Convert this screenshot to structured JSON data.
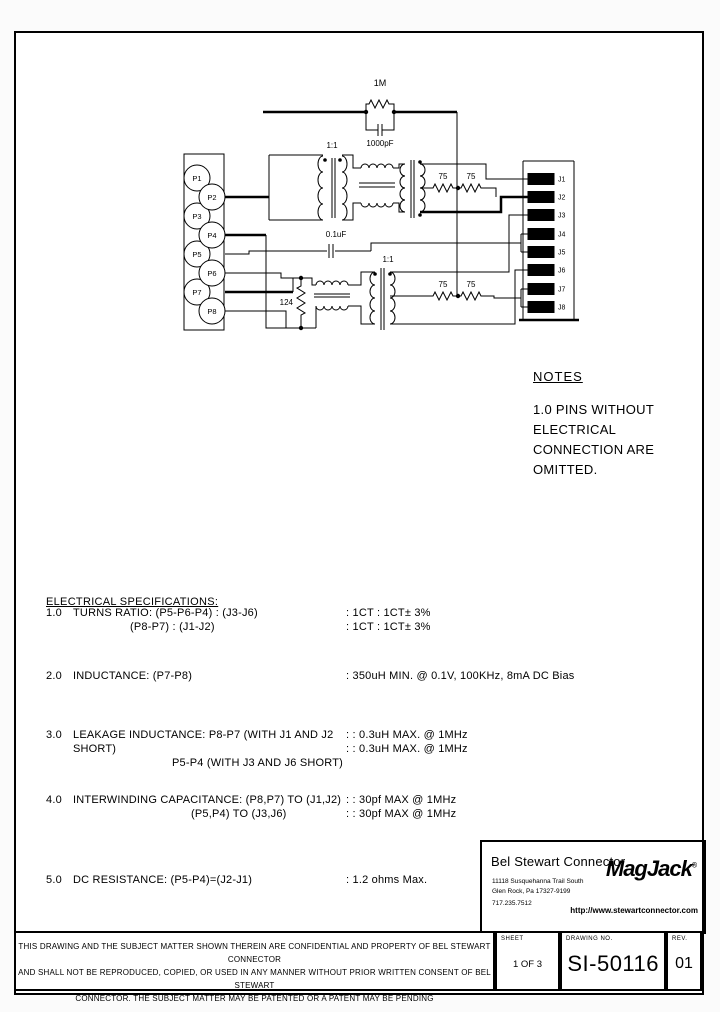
{
  "schematic": {
    "pin_labels_p": [
      "P1",
      "P2",
      "P3",
      "P4",
      "P5",
      "P6",
      "P7",
      "P8"
    ],
    "pin_labels_j": [
      "J1",
      "J2",
      "J3",
      "J4",
      "J5",
      "J6",
      "J7",
      "J8"
    ],
    "labels": {
      "resistor_top": "1M",
      "cap_top": "1000pF",
      "transformer_top": "1:1",
      "transformer_bottom": "1:1",
      "cap_mid": "0.1uF",
      "resistor_shunt": "124",
      "resistor_term": "75"
    }
  },
  "notes": {
    "title": "NOTES",
    "line1": "1.0 PINS WITHOUT ELECTRICAL",
    "line2": "CONNECTION ARE OMITTED."
  },
  "specs": {
    "title": "ELECTRICAL SPECIFICATIONS:",
    "items": [
      {
        "num": "1.0",
        "line1": "TURNS RATIO: (P5-P6-P4) : (J3-J6)",
        "line2": "(P8-P7) : (J1-J2)",
        "val1": ": 1CT : 1CT± 3%",
        "val2": ": 1CT : 1CT± 3%"
      },
      {
        "num": "2.0",
        "line1": "INDUCTANCE:  (P7-P8)",
        "val1": ": 350uH MIN. @ 0.1V, 100KHz, 8mA DC Bias"
      },
      {
        "num": "3.0",
        "line1": "LEAKAGE INDUCTANCE:  P8-P7 (WITH J1 AND J2 SHORT)",
        "line2": "P5-P4 (WITH J3 AND J6 SHORT)",
        "val1": ": : 0.3uH MAX. @ 1MHz",
        "val2": ": : 0.3uH MAX. @ 1MHz"
      },
      {
        "num": "4.0",
        "line1": "INTERWINDING CAPACITANCE: (P8,P7) TO (J1,J2)",
        "line2": "(P5,P4) TO (J3,J6)",
        "val1": ": : 30pf MAX @ 1MHz",
        "val2": ": : 30pf MAX @ 1MHz"
      },
      {
        "num": "5.0",
        "line1": "DC RESISTANCE: (P5-P4)=(J2-J1)",
        "val1": ": 1.2 ohms Max."
      }
    ]
  },
  "title_block": {
    "company": "Bel Stewart Connector",
    "address1": "11118 Susquehanna Trail South",
    "address2": "Glen Rock, Pa  17327-9199",
    "phone": "717.235.7512",
    "logo": "MagJack",
    "logo_reg": "®",
    "url": "http://www.stewartconnector.com"
  },
  "footer": {
    "disclaimer1": "THIS DRAWING AND THE SUBJECT MATTER SHOWN THEREIN ARE CONFIDENTIAL AND PROPERTY OF BEL STEWART CONNECTOR",
    "disclaimer2": "AND SHALL NOT BE REPRODUCED, COPIED, OR USED IN ANY MANNER WITHOUT PRIOR WRITTEN CONSENT OF BEL STEWART",
    "disclaimer3": "CONNECTOR.  THE SUBJECT MATTER MAY BE PATENTED OR A PATENT MAY BE PENDING",
    "sheet_label": "SHEET",
    "sheet_value": "1 OF 3",
    "drawing_label": "DRAWING NO.",
    "rev_label": "REV.",
    "drawing_value": "SI-50116",
    "rev_value": "01"
  }
}
